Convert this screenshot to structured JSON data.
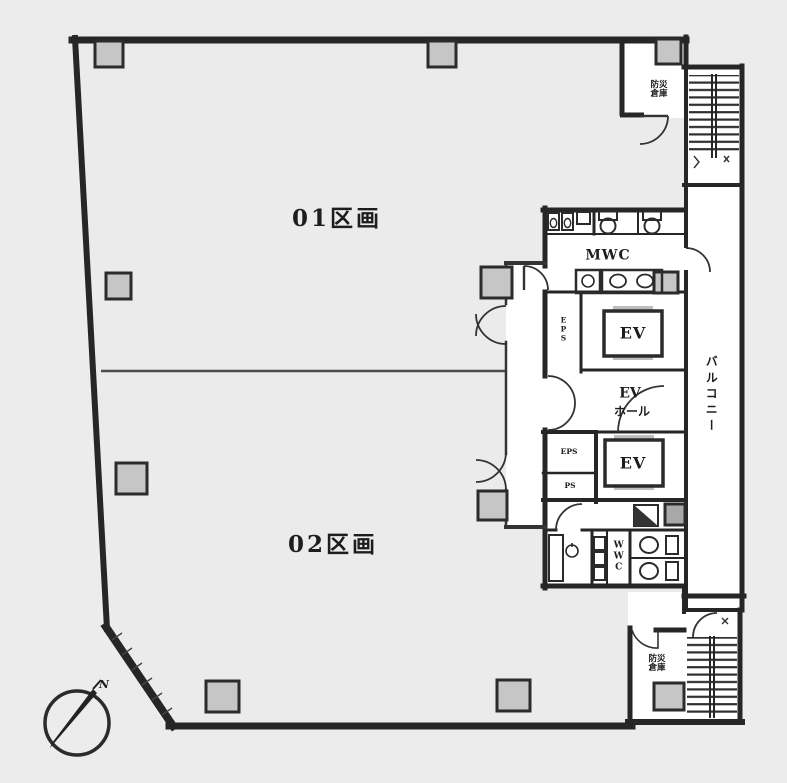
{
  "document": {
    "type": "building-floor-plan",
    "colors": {
      "background": "#ececec",
      "floor": "#ebebeb",
      "wall": "#262626",
      "column_fill": "#c6c6c6",
      "white_area": "#ffffff",
      "text": "#1d1d1d"
    }
  },
  "labels": {
    "unit01": "01区画",
    "unit02": "02区画",
    "mwc": "MWC",
    "wwc": "WWC",
    "ev_upper": "EV",
    "ev_lower": "EV",
    "ev_hall_line1": "EV",
    "ev_hall_line2": "ホール",
    "balcony": "バルコニー",
    "storage_top_line1": "防災",
    "storage_top_line2": "倉庫",
    "storage_bottom_line1": "防災",
    "storage_bottom_line2": "倉庫",
    "eps": "EPS",
    "ps": "PS",
    "duct_shaft": "EPS",
    "north": "N"
  }
}
